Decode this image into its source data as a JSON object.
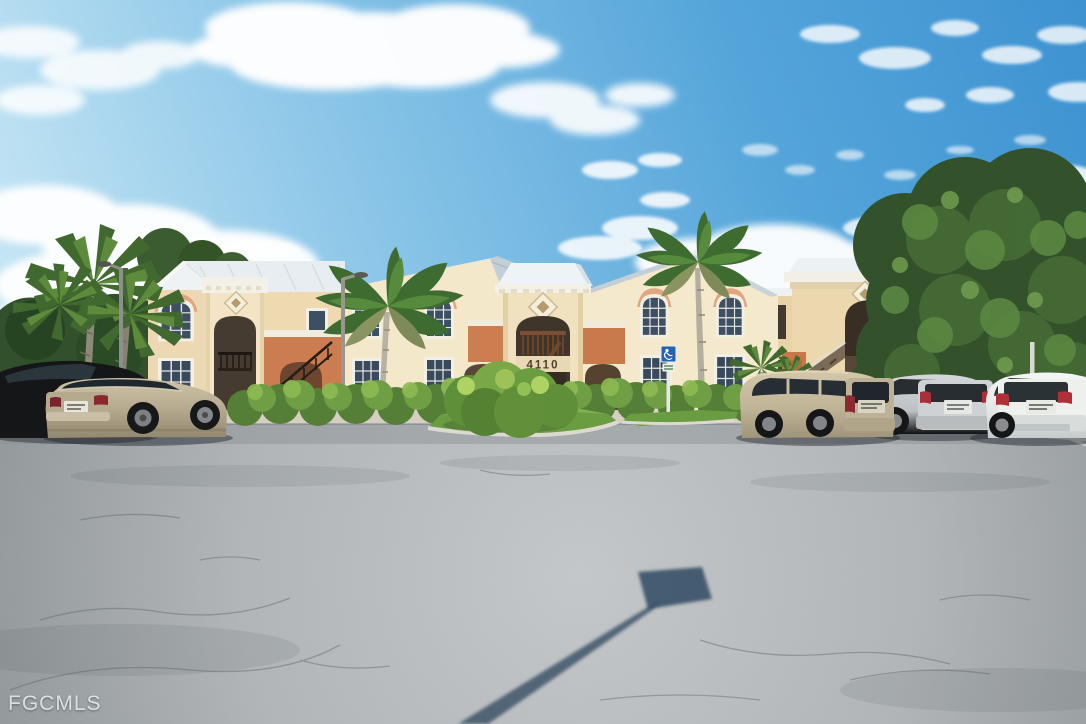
{
  "scene": {
    "description": "Sunny exterior photo of a two-story tan stucco condominium complex with white roofs, arched entries, palm trees, a large oak tree, landscaped hedges and a weathered asphalt parking lot with parked cars",
    "building_number": "4110",
    "watermark": "FGCMLS"
  },
  "colors": {
    "sky_top": "#3d92d0",
    "sky_horizon": "#cdeaf6",
    "cloud_white": "#ffffff",
    "wall_cream": "#f3e6c8",
    "wall_shadow": "#e2cda4",
    "accent_terracotta": "#cb7c50",
    "trim_peach": "#e3a57d",
    "roof_white": "#eaf0f4",
    "roof_shingle": "#c3ced6",
    "window_glass": "#3d5063",
    "asphalt_light": "#c7cacc",
    "asphalt_dark": "#8e9497",
    "grass_green": "#6a9c42",
    "hedge_green": "#79a846",
    "tree_dark_green": "#33522c",
    "palm_green": "#4c7a38",
    "sign_blue": "#2563b0",
    "shadow_blue": "#27415c"
  },
  "vehicles": [
    {
      "name": "black-sedan",
      "color": "#141618"
    },
    {
      "name": "gold-sedan",
      "color": "#bcb096"
    },
    {
      "name": "gold-minivan",
      "color": "#c8bc9f"
    },
    {
      "name": "silver-suv",
      "color": "#c6cacc"
    },
    {
      "name": "white-suv",
      "color": "#eff1f0"
    }
  ],
  "signs": {
    "handicap_parking": "handicap-parking-sign"
  }
}
